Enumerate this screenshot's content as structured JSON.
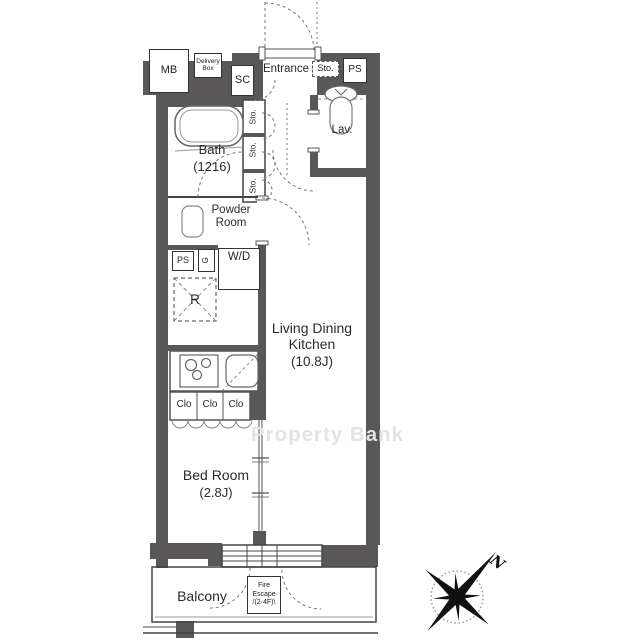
{
  "watermark": "Property Bank",
  "compass": {
    "north": "N"
  },
  "boxes": {
    "mb": "MB",
    "delivery_box": "Delivery Box",
    "sc": "SC",
    "sto_top": "Sto.",
    "ps_top": "PS",
    "ps_mid": "PS",
    "utility": "G",
    "washer_dryer": "W/D",
    "refrigerator": "R",
    "closet": "Clo",
    "storage_vertical": "Sto."
  },
  "rooms": {
    "entrance": "Entrance",
    "bath": "Bath",
    "bath_size": "(1216)",
    "lavatory": "Lav.",
    "powder_room": "Powder Room",
    "ldk_line1": "Living Dining",
    "ldk_line2": "Kitchen",
    "ldk_size": "(10.8J)",
    "bedroom": "Bed Room",
    "bedroom_size": "(2.8J)",
    "balcony": "Balcony"
  },
  "fire_escape": {
    "line1": "Fire",
    "line2": "Escape",
    "line3": "/(2·4F)\\"
  },
  "colors": {
    "wall": "#595757",
    "line": "#444444",
    "watermark": "#e3e3e3"
  }
}
